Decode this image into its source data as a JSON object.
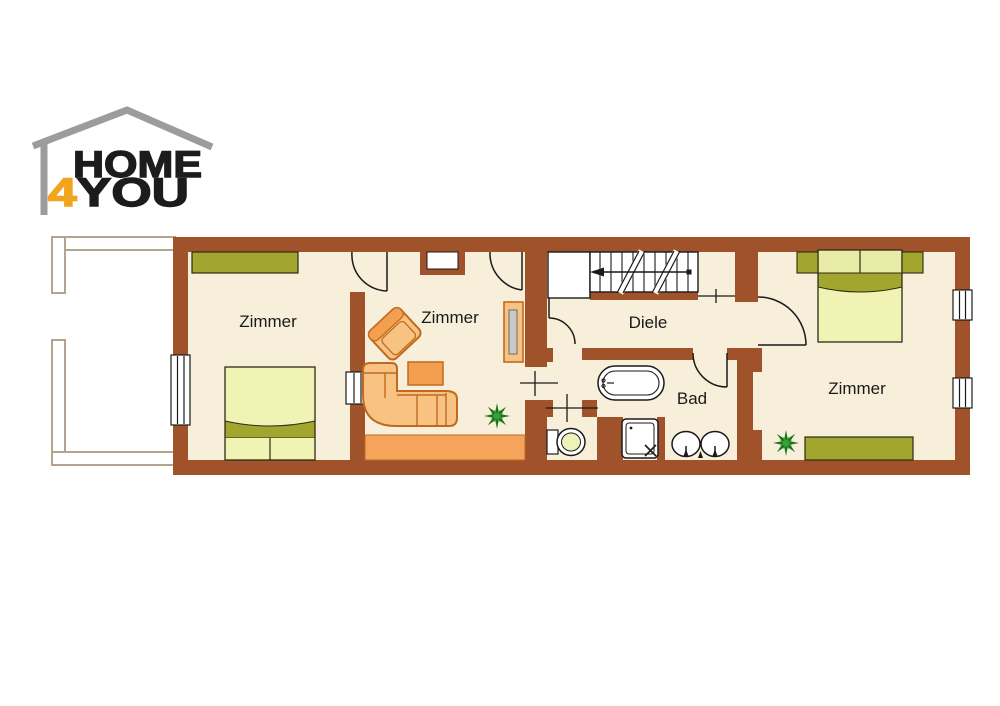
{
  "brand": {
    "word_top": "HOME",
    "digit": "4",
    "word_bottom": "YOU",
    "logo_gray": "#9C9C9C",
    "logo_black": "#1C1C1C",
    "digit_orange": "#F2A41F"
  },
  "rooms": {
    "bedroom_left": {
      "label": "Zimmer"
    },
    "living_room": {
      "label": "Zimmer"
    },
    "hall": {
      "label": "Diele"
    },
    "bath": {
      "label": "Bad"
    },
    "bedroom_right": {
      "label": "Zimmer"
    }
  },
  "colors": {
    "wall_brown": "#A0522B",
    "room_cream": "#F7EFD9",
    "furniture_orange_light": "#F8C382",
    "furniture_orange_mid": "#F2A050",
    "furniture_orange_border": "#C06A20",
    "furniture_olive": "#A2A62F",
    "bed_light_yellow": "#F1F3B4",
    "plant_green": "#1E741E",
    "balcony_outline_tan": "#B3A48B"
  },
  "icons": [
    "house-logo-icon",
    "staircase-icon",
    "stair-direction-arrow-icon",
    "wardrobe-icon",
    "double-bed-icon",
    "nightstand-icon",
    "corner-sofa-icon",
    "armchair-icon",
    "coffee-table-icon",
    "tv-board-icon",
    "chimney-niche-icon",
    "plant-icon",
    "bathtub-icon",
    "shower-icon",
    "toilet-icon",
    "washbasin-icon",
    "window-icon",
    "door-arc-icon",
    "wall-opening-cross-icon",
    "balcony-icon"
  ]
}
